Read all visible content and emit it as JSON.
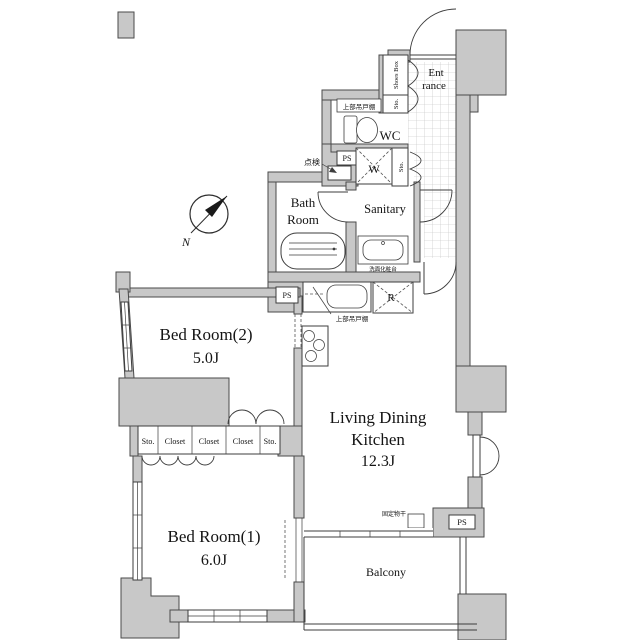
{
  "fp": {
    "rooms": {
      "entrance": {
        "l1": "Ent",
        "l2": "rance"
      },
      "wc": {
        "name": "WC"
      },
      "bath": {
        "l1": "Bath",
        "l2": "Room"
      },
      "sanitary": {
        "name": "Sanitary"
      },
      "bedroom2": {
        "name": "Bed Room(2)",
        "size": "5.0J"
      },
      "bedroom1": {
        "name": "Bed Room(1)",
        "size": "6.0J"
      },
      "ldk": {
        "l1": "Living Dining",
        "l2": "Kitchen",
        "size": "12.3J"
      },
      "balcony": {
        "name": "Balcony"
      }
    },
    "fixtures": {
      "washer": "W",
      "fridge": "R",
      "ps_top": "PS",
      "ps_kitchen": "PS",
      "ps_balcony": "PS",
      "shoes_box": "Shoes Box",
      "sto_entrance": "Sto.",
      "sto_hall": "Sto.",
      "cupboard_wc": "上部吊戸棚",
      "cupboard_kitchen": "上部吊戸棚",
      "inspection": "点検",
      "washstand": "洗面化粧台",
      "fixed_pole": "固定物干"
    },
    "closets": [
      "Sto.",
      "Closet",
      "Closet",
      "Closet",
      "Sto."
    ],
    "compass_n": "N"
  }
}
